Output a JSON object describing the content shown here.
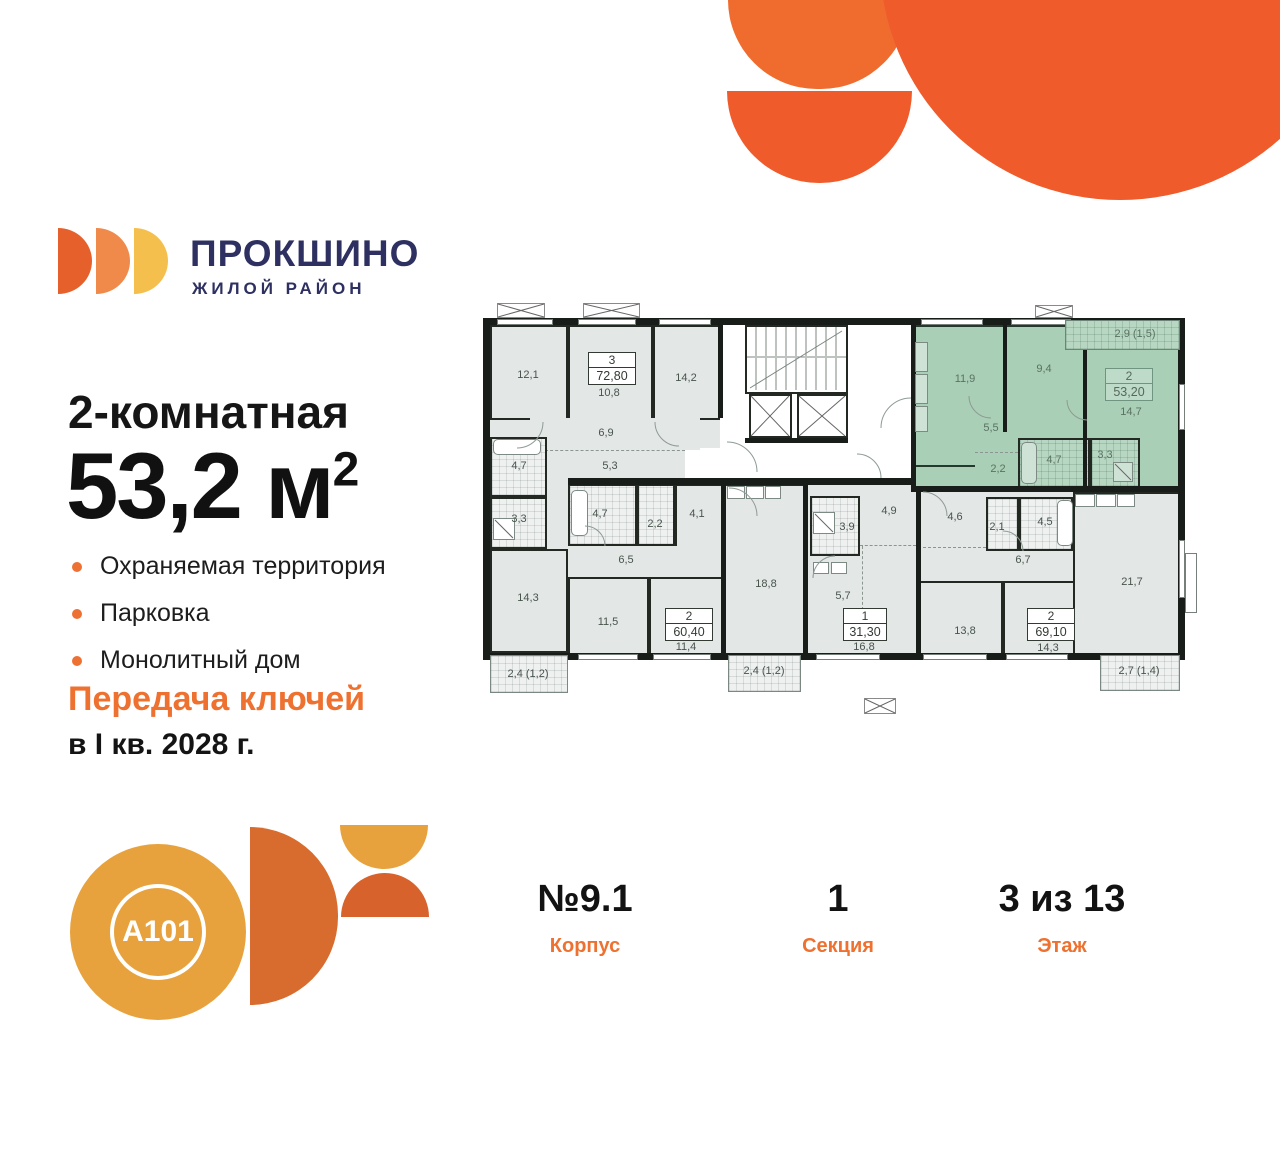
{
  "brand": {
    "name": "ПРОКШИНО",
    "tagline": "ЖИЛОЙ РАЙОН",
    "developer": "A101"
  },
  "offer": {
    "title": "2-комнатная",
    "area_value": "53,2",
    "area_unit": "м",
    "area_sup": "2",
    "features": [
      "Охраняемая территория",
      "Парковка",
      "Монолитный дом"
    ],
    "handover_line1": "Передача ключей",
    "handover_line2": "в I кв. 2028 г."
  },
  "footer": {
    "building_value": "№9.1",
    "building_label": "Корпус",
    "section_value": "1",
    "section_label": "Секция",
    "floor_value": "3 из 13",
    "floor_label": "Этаж"
  },
  "colors": {
    "accent_orange": "#EE7130",
    "deep_orange": "#EF5B2B",
    "light_orange": "#EF6C2E",
    "navy": "#2D3060",
    "plan_green": "#A9CFB6",
    "plan_gray": "#E3E7E6",
    "logo_yellow": "#F5BF4D",
    "a101_yellow": "#E7A23D"
  },
  "plan": {
    "units": [
      {
        "id": "3",
        "total": "72,80",
        "rooms": [
          "12,1",
          "10,8",
          "14,2",
          "6,9",
          "5,3",
          "4,7",
          "3,3",
          "14,3"
        ],
        "balcony": "2,4 (1,2)"
      },
      {
        "id": "2",
        "total": "60,40",
        "rooms": [
          "4,7",
          "2,2",
          "4,1",
          "6,5",
          "11,5",
          "11,4",
          "18,8"
        ],
        "balcony": "2,4 (1,2)"
      },
      {
        "id": "1",
        "total": "31,30",
        "rooms": [
          "3,9",
          "4,9",
          "5,7",
          "16,8"
        ]
      },
      {
        "id": "2",
        "total": "69,10",
        "rooms": [
          "4,6",
          "2,1",
          "4,5",
          "6,7",
          "13,8",
          "14,3",
          "21,7"
        ],
        "balcony": "2,7 (1,4)"
      },
      {
        "id": "2",
        "total": "53,20",
        "rooms": [
          "11,9",
          "9,4",
          "14,7",
          "5,5",
          "2,2",
          "4,7",
          "3,3"
        ],
        "balcony": "2,9 (1,5)"
      }
    ]
  }
}
